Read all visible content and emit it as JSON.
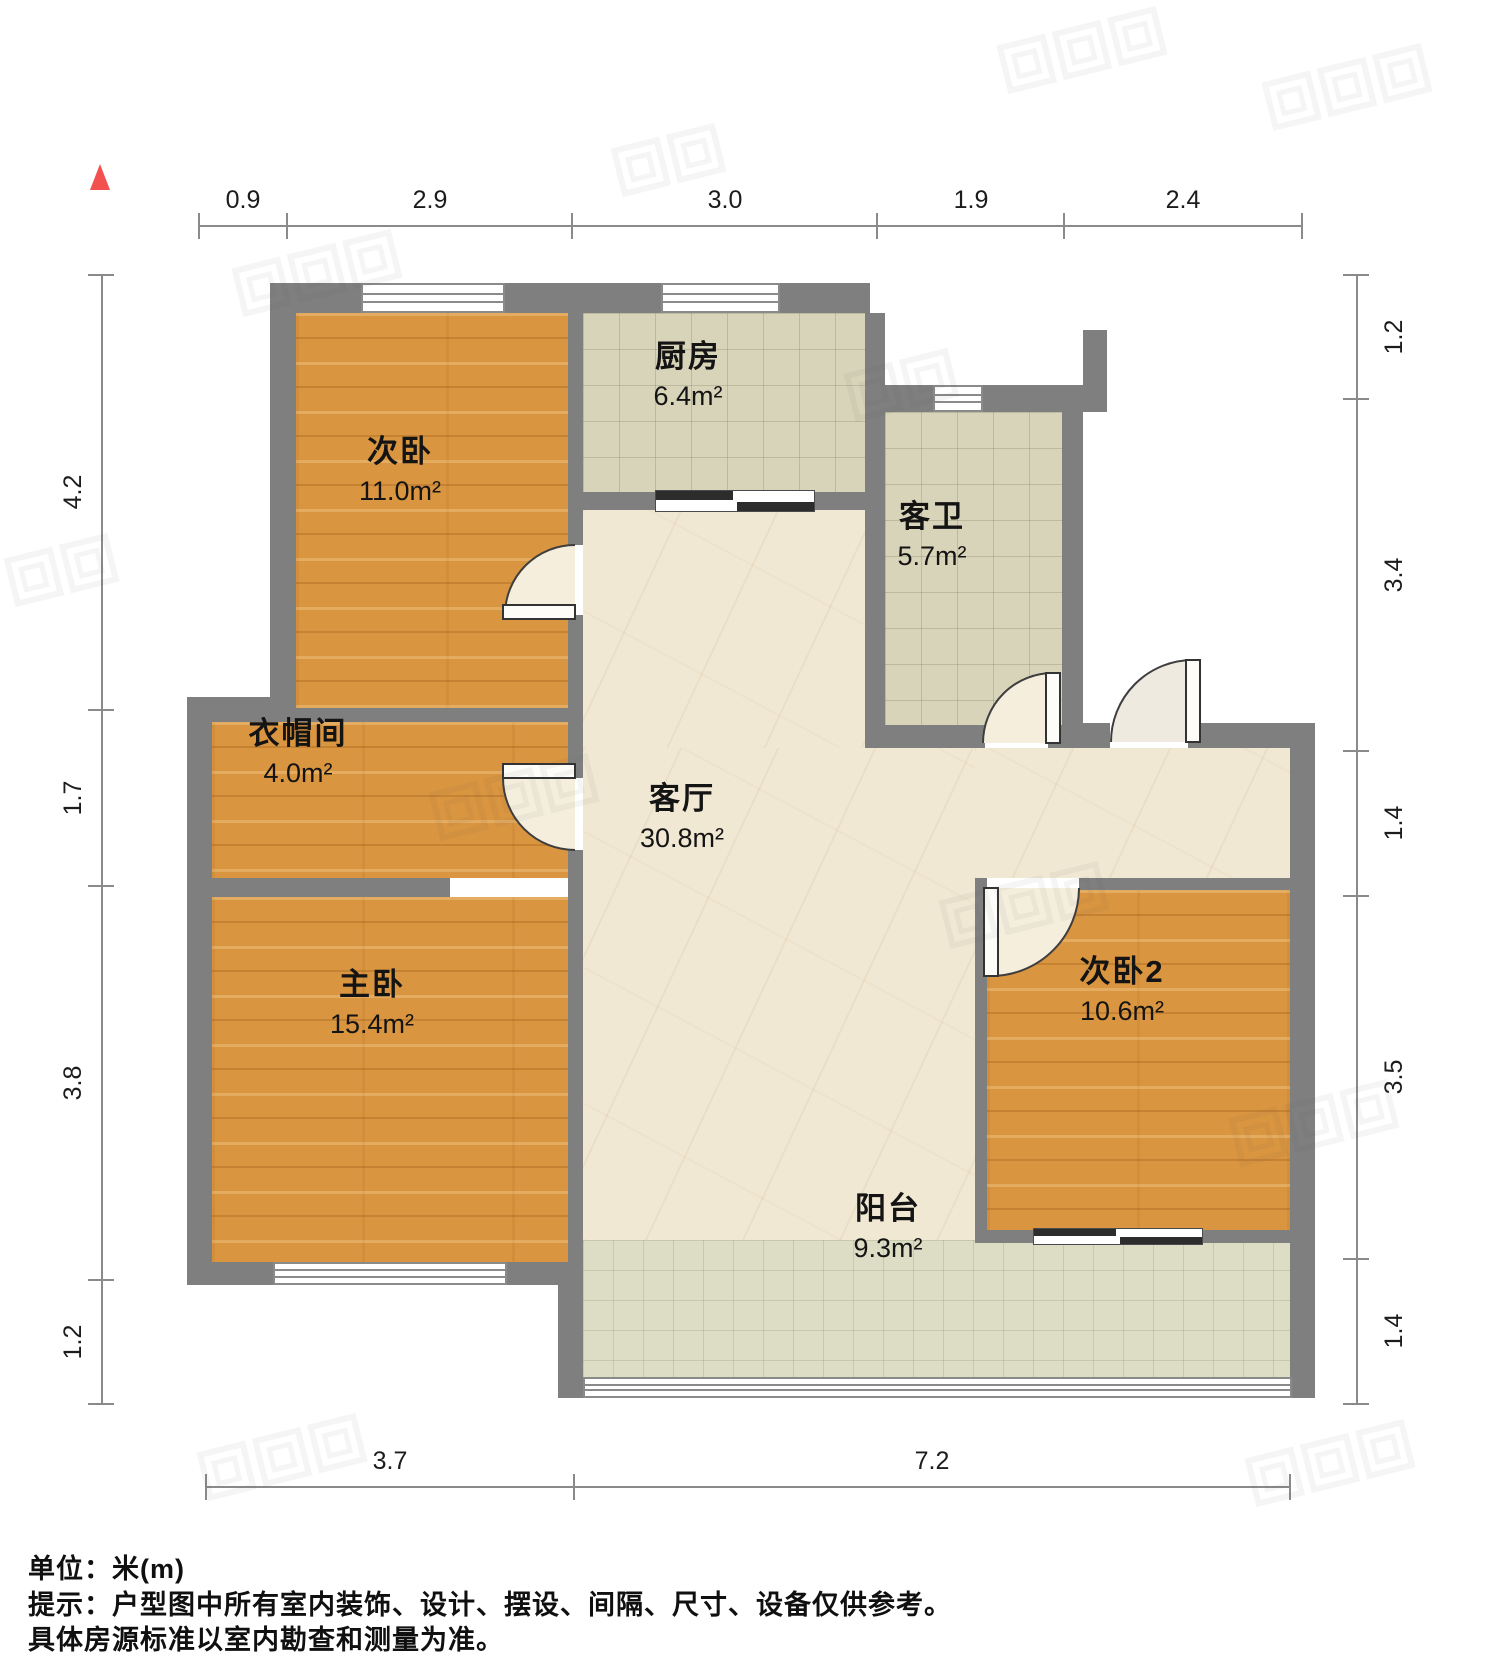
{
  "page": {
    "type": "residential-floor-plan"
  },
  "rooms": {
    "bedroom2": {
      "name": "次卧",
      "area": "11.0m²"
    },
    "kitchen": {
      "name": "厨房",
      "area": "6.4m²"
    },
    "bathroom": {
      "name": "客卫",
      "area": "5.7m²"
    },
    "cloakroom": {
      "name": "衣帽间",
      "area": "4.0m²"
    },
    "living": {
      "name": "客厅",
      "area": "30.8m²"
    },
    "master": {
      "name": "主卧",
      "area": "15.4m²"
    },
    "bedroom3": {
      "name": "次卧2",
      "area": "10.6m²"
    },
    "balcony": {
      "name": "阳台",
      "area": "9.3m²"
    }
  },
  "dimensions": {
    "top": [
      "0.9",
      "2.9",
      "3.0",
      "1.9",
      "2.4"
    ],
    "left": [
      "4.2",
      "1.7",
      "3.8",
      "1.2"
    ],
    "right": [
      "1.2",
      "3.4",
      "1.4",
      "3.5",
      "1.4"
    ],
    "bottom": [
      "3.7",
      "7.2"
    ]
  },
  "footer": {
    "unit": "单位：米(m)",
    "note1": "提示：户型图中所有室内装饰、设计、摆设、间隔、尺寸、设备仅供参考。",
    "note2": "具体房源标准以室内勘查和测量为准。"
  },
  "colors": {
    "wall": "#7f7f7f",
    "wood_floor": "#d9953f",
    "tile_floor": "#d8d4b9",
    "marble_floor": "#f1e8d4",
    "balcony_floor": "#dcddc4",
    "north_arrow": "#f2514f",
    "dim_line": "#8a8a8a",
    "text": "#141414"
  }
}
